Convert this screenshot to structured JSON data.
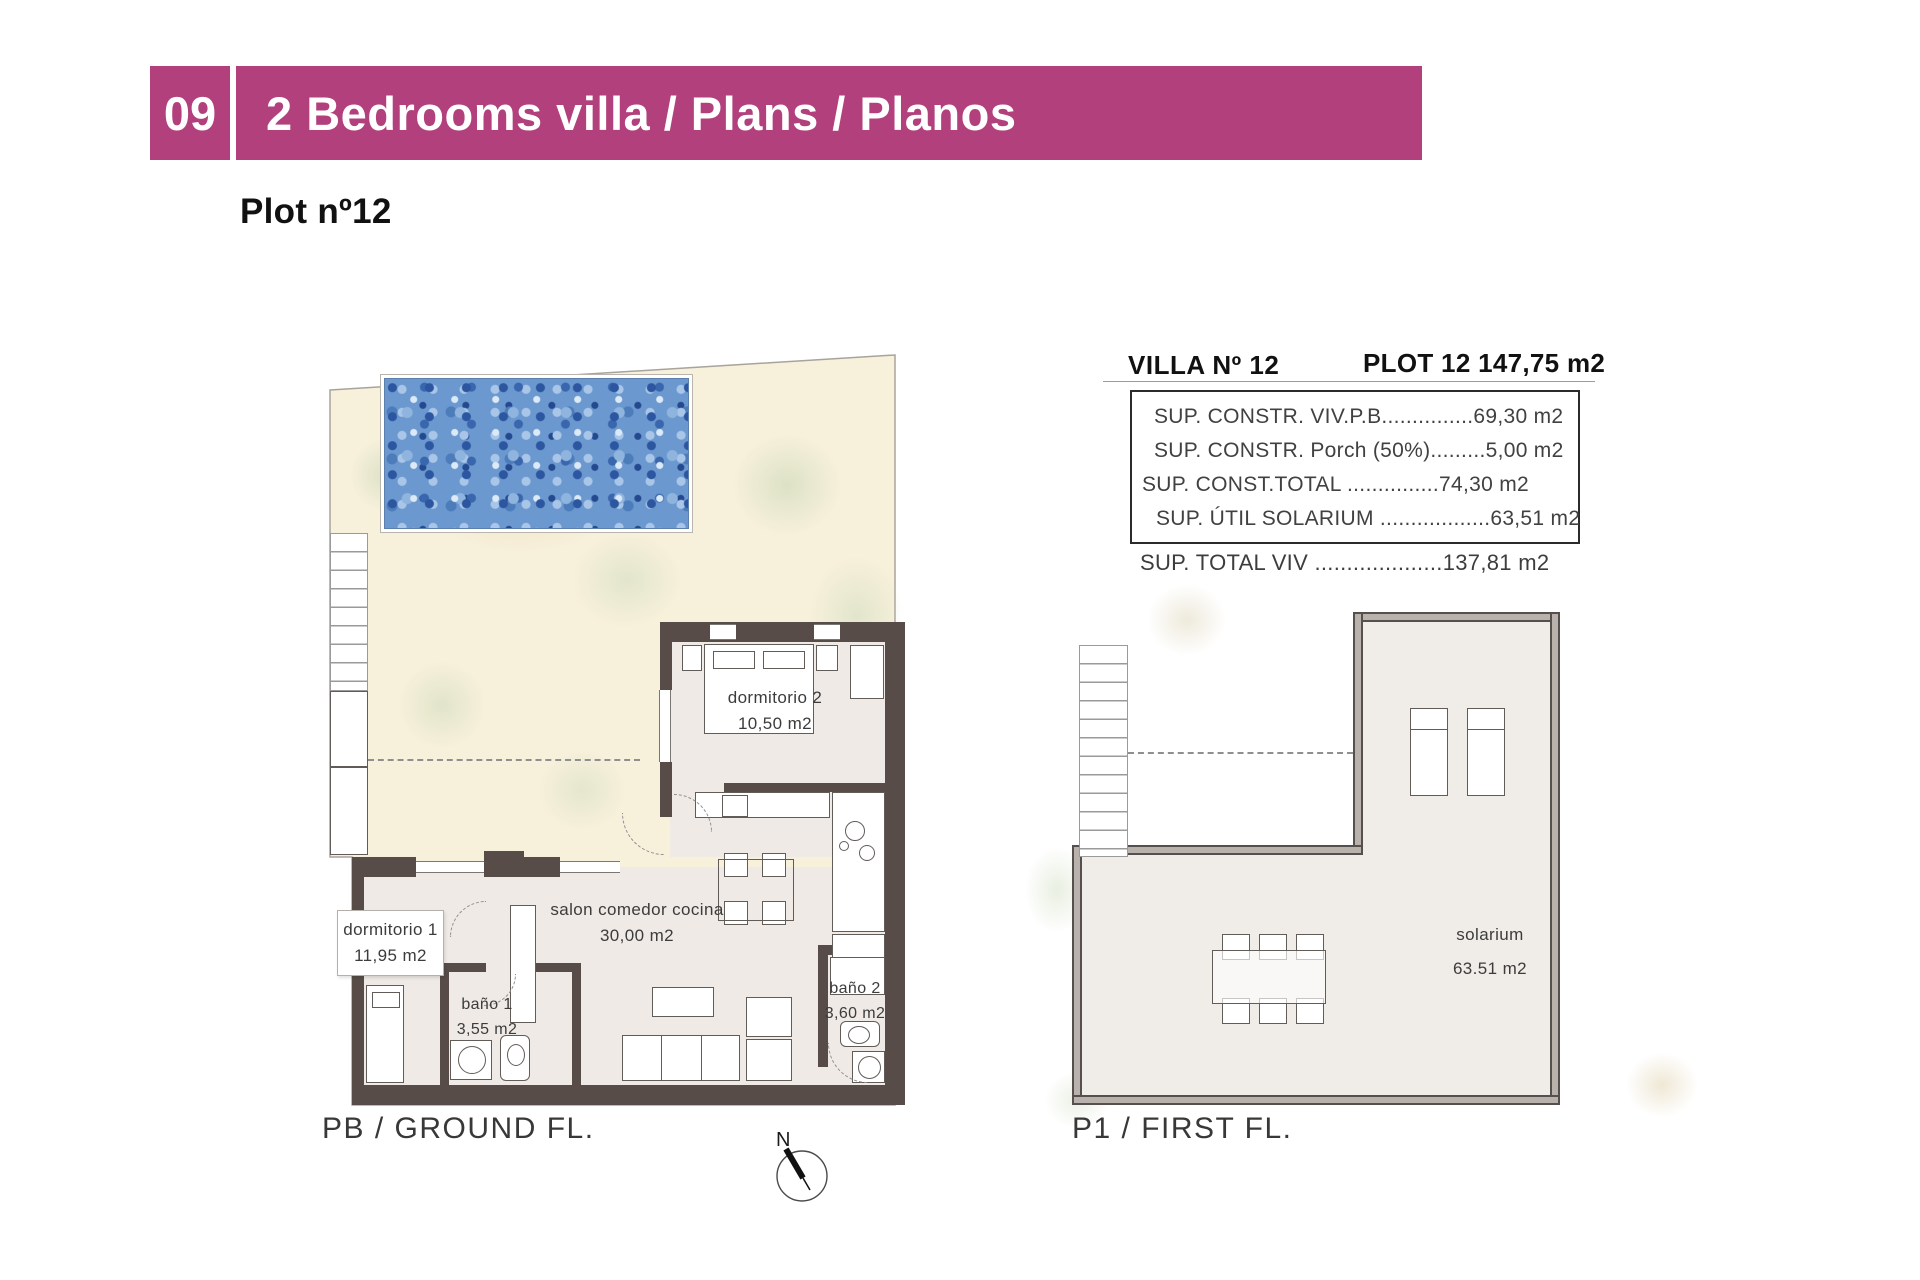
{
  "header": {
    "number": "09",
    "title": "2 Bedrooms villa / Plans / Planos"
  },
  "plot_heading": "Plot nº12",
  "info_panel": {
    "villa_title": "VILLA Nº 12",
    "plot_title": "PLOT 12 147,75 m2",
    "rows": [
      "SUP. CONSTR. VIV.P.B...............69,30 m2",
      "SUP. CONSTR. Porch (50%).........5,00 m2",
      "SUP. CONST.TOTAL ...............74,30 m2",
      "SUP. ÚTIL SOLARIUM ..................63,51 m2"
    ],
    "total_row": "SUP. TOTAL VIV ....................137,81 m2"
  },
  "ground_floor": {
    "caption": "PB / GROUND FL.",
    "rooms": [
      {
        "name": "dormitorio 2",
        "area": "10,50 m2"
      },
      {
        "name": "salon comedor cocina",
        "area": "30,00 m2"
      },
      {
        "name": "dormitorio 1",
        "area": "11,95 m2"
      },
      {
        "name": "baño 1",
        "area": "3,55 m2"
      },
      {
        "name": "baño 2",
        "area": "3,60 m2"
      }
    ]
  },
  "first_floor": {
    "caption": "P1 / FIRST FL.",
    "room": {
      "name": "solarium",
      "area": "63.51 m2"
    }
  },
  "compass": {
    "label": "N"
  },
  "colors": {
    "accent": "#b2407d",
    "wall": "#574c48",
    "pool": "#6b98cf",
    "terrace": "#f7f0db"
  }
}
